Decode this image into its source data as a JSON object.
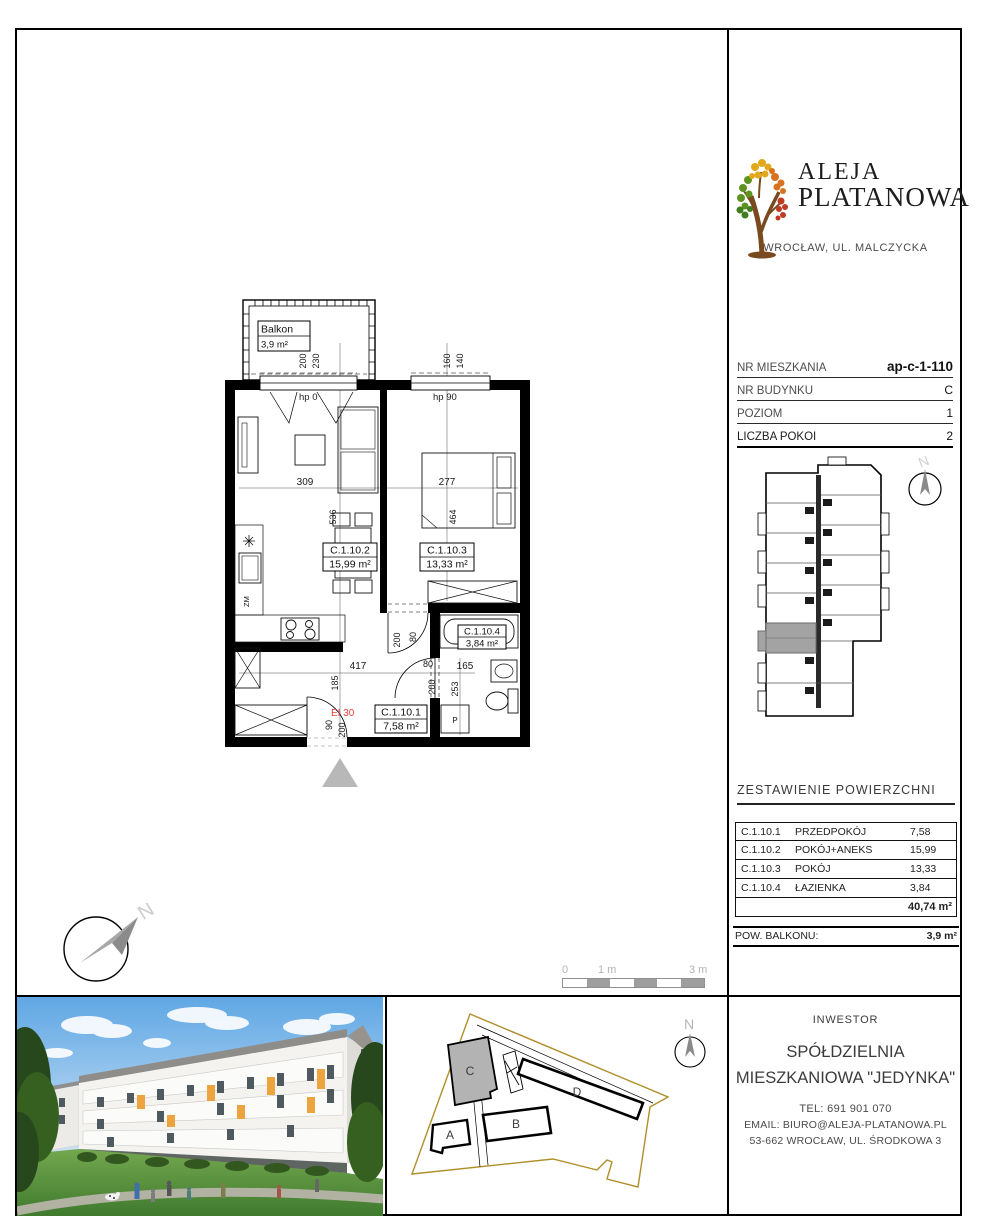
{
  "brand": {
    "line1": "ALEJA",
    "line2": "PLATANOWA",
    "location": "WROCŁAW, UL. MALCZYCKA"
  },
  "unit_info": {
    "rows": [
      {
        "label": "NR MIESZKANIA",
        "value": "ap-c-1-110"
      },
      {
        "label": "NR BUDYNKU",
        "value": "C"
      },
      {
        "label": "POZIOM",
        "value": "1"
      },
      {
        "label": "LICZBA POKOI",
        "value": "2"
      }
    ]
  },
  "plan": {
    "balcony_label": "Balkon",
    "balcony_area": "3,9 m²",
    "room1_id": "C.1.10.1",
    "room1_area": "7,58 m²",
    "room2_id": "C.1.10.2",
    "room2_area": "15,99 m²",
    "room3_id": "C.1.10.3",
    "room3_area": "13,33 m²",
    "room4_id": "C.1.10.4",
    "room4_area": "3,84 m²",
    "fire_rating": "EI 30",
    "hp_left": "hp 0",
    "hp_right": "hp 90",
    "zm": "ZM",
    "p": "P",
    "dims": {
      "balcony_door_w": "200",
      "balcony_door_w2": "230",
      "window_w": "160",
      "window_w2": "140",
      "living_w": "309",
      "bedroom_w": "277",
      "living_h": "536",
      "bedroom_h": "464",
      "hall_w": "417",
      "hall_h": "185",
      "door80": "80",
      "d165": "165",
      "d200": "200",
      "d253": "253",
      "entry_w": "90",
      "entry_h": "200"
    }
  },
  "compass": {
    "n": "N"
  },
  "scale_bar": {
    "t0": "0",
    "t1": "1 m",
    "t3": "3 m"
  },
  "areas": {
    "title": "ZESTAWIENIE POWIERZCHNI",
    "rows": [
      {
        "id": "C.1.10.1",
        "name": "PRZEDPOKÓJ",
        "value": "7,58"
      },
      {
        "id": "C.1.10.2",
        "name": "POKÓJ+ANEKS",
        "value": "15,99"
      },
      {
        "id": "C.1.10.3",
        "name": "POKÓJ",
        "value": "13,33"
      },
      {
        "id": "C.1.10.4",
        "name": "ŁAZIENKA",
        "value": "3,84"
      }
    ],
    "total": "40,74 m²",
    "balcony_label": "POW. BALKONU:",
    "balcony_value": "3,9 m²"
  },
  "site": {
    "a": "A",
    "b": "B",
    "c": "C",
    "d": "D"
  },
  "investor": {
    "header": "INWESTOR",
    "name1": "SPÓŁDZIELNIA",
    "name2": "MIESZKANIOWA \"JEDYNKA\"",
    "tel": "TEL: 691 901 070",
    "email": "EMAIL: BIURO@ALEJA-PLATANOWA.PL",
    "address": "53-662 WROCŁAW, UL. ŚRODKOWA 3"
  }
}
